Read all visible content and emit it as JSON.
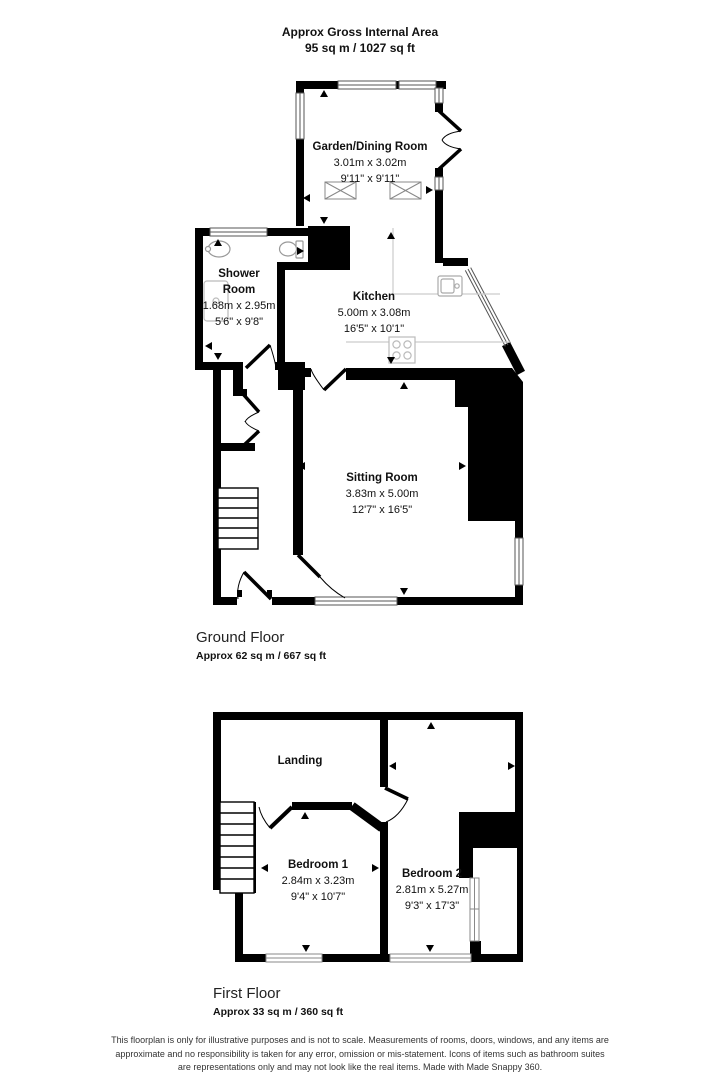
{
  "header": {
    "line1": "Approx Gross Internal Area",
    "line2": "95 sq m / 1027 sq ft"
  },
  "ground": {
    "title": "Ground Floor",
    "area": "Approx 62 sq m / 667 sq ft",
    "rooms": [
      {
        "name": "Garden/Dining Room",
        "metric": "3.01m x 3.02m",
        "imperial": "9'11\" x 9'11\""
      },
      {
        "name": "Shower Room",
        "metric": "1.68m x 2.95m",
        "imperial": "5'6\" x 9'8\""
      },
      {
        "name": "Kitchen",
        "metric": "5.00m x 3.08m",
        "imperial": "16'5\" x 10'1\""
      },
      {
        "name": "Sitting Room",
        "metric": "3.83m x 5.00m",
        "imperial": "12'7\" x 16'5\""
      }
    ]
  },
  "first": {
    "title": "First Floor",
    "area": "Approx 33 sq m / 360 sq ft",
    "rooms": [
      {
        "name": "Landing"
      },
      {
        "name": "Bedroom 1",
        "metric": "2.84m x 3.23m",
        "imperial": "9'4\" x 10'7\""
      },
      {
        "name": "Bedroom 2",
        "metric": "2.81m x 5.27m",
        "imperial": "9'3\" x 17'3\""
      }
    ]
  },
  "footer": {
    "line1": "This floorplan is only for illustrative purposes and is not to scale. Measurements of rooms, doors, windows, and any items are",
    "line2": "approximate and no responsibility is taken for any error, omission or mis-statement. Icons of items such as bathroom suites",
    "line3": "are representations only and may not look like the real items. Made with Made Snappy 360."
  },
  "symbols": {
    "measure_arrow": "filled triangle pointing at measured wall",
    "skylight": "rectangle with crossed diagonals",
    "window": "white strip with triple parallel lines",
    "door": "thick leaf line with quarter-circle swing arc"
  },
  "colors": {
    "wall": "#000000",
    "window_line": "#555555",
    "fixture_line": "#aaaaaa",
    "counter_line": "#cccccc",
    "text": "#111111",
    "disclaimer_text": "#333333"
  }
}
